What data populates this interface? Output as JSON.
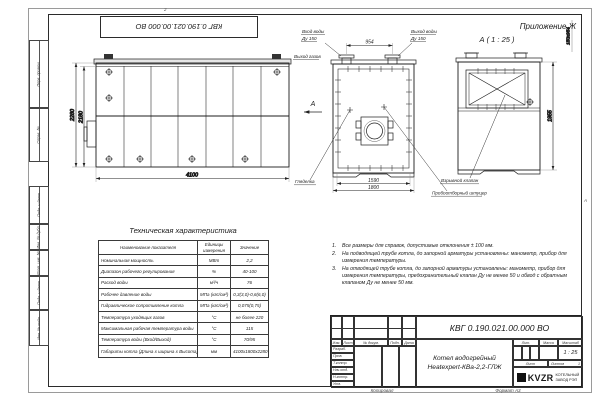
{
  "sheet": {
    "appendix": "Приложение Ж",
    "stamp_number": "КВГ 0.190.021.00.000 ВО",
    "zone_top": "2",
    "zone_right": "А",
    "copied_label": "Копировал",
    "format_label": "Формат А3"
  },
  "frame_columns": {
    "perv_primen": "Перв. примен.",
    "sprav_no": "Справ. №",
    "podp_data1": "Подп. и дата",
    "inv_dubl": "Инв. № дубл.",
    "vzam_inv": "Взам. инв. №",
    "podp_data2": "Подп. и дата",
    "inv_podl": "Инв. № подл."
  },
  "views": {
    "side": {
      "dim_height_outer": "2280",
      "dim_height_inner": "2180",
      "dim_length": "4100"
    },
    "front": {
      "inlet_line1": "Вход воды",
      "inlet_line2": "Ду 150",
      "outlet_line1": "Выход воды",
      "outlet_line2": "Ду 150",
      "gas_label": "Выход газов",
      "dim_top": "954",
      "dim_bottom_inner": "1590",
      "dim_bottom_outer": "1800",
      "section_letter": "А",
      "sight_label": "Гляделка",
      "sampling_label": "Пробоотборный штуцер"
    },
    "section": {
      "title": "А ( 1 : 25 )",
      "dim_height": "1955",
      "dim_top": "150х954",
      "valve_label": "Взрывной клапан"
    }
  },
  "tech_table": {
    "title": "Техническая характеристика",
    "headers": [
      "Наименование показателя",
      "Единицы измерения",
      "Значение"
    ],
    "rows": [
      {
        "name": "Номинальная мощность",
        "unit": "МВт",
        "value": "2,2"
      },
      {
        "name": "Диапазон рабочего регулирования",
        "unit": "%",
        "value": "40-100"
      },
      {
        "name": "Расход воды",
        "unit": "м³/ч",
        "value": "76"
      },
      {
        "name": "Рабочее давление воды",
        "unit": "МПа (кгс/см²)",
        "value": "0,3(3,0)-0,6(6,0)"
      },
      {
        "name": "Гидравлическое сопротивление котла",
        "unit": "МПа (кгс/см²)",
        "value": "0,075(0,75)"
      },
      {
        "name": "Температура уходящих газов",
        "unit": "°С",
        "value": "не более 220"
      },
      {
        "name": "Максимальная рабочая температура воды",
        "unit": "°С",
        "value": "115"
      },
      {
        "name": "Температура воды (Вход/Выход)",
        "unit": "°С",
        "value": "70/95"
      },
      {
        "name": "Габариты котла (Длина х ширина х Высота)",
        "unit": "мм",
        "value": "4100х1800х2280"
      }
    ]
  },
  "notes": {
    "items": [
      {
        "num": "1.",
        "text": "Все размеры для справок, допустимые отклонения ± 100 мм."
      },
      {
        "num": "2.",
        "text": "На подводящей трубе котла, до запорной арматуры установлены: манометр, прибор для измерения температуры."
      },
      {
        "num": "3.",
        "text": "На отводящей трубе котла, до запорной арматуры установлены: манометр, прибор для измерения температуры, предохранительный клапан Ду не менее 50 и обвод с обратным клапаном Ду не менее 50 мм."
      }
    ]
  },
  "title_block": {
    "doc_number": "КВГ 0.190.021.00.000 ВО",
    "product_line1": "Котел водогрейный",
    "product_line2": "Heatexpert-КВа-2,2-ГЛЖ",
    "header_cols": [
      "Изм.",
      "Лист",
      "№ докум.",
      "Подп.",
      "Дата"
    ],
    "sign_rows": [
      "Разраб.",
      "Пров.",
      "Т.контр.",
      "Нач.отд.",
      "Н.контр.",
      "Утв."
    ],
    "lit_label": "Лит.",
    "mass_label": "Масса",
    "scale_label": "Масштаб",
    "scale_value": "1 : 25",
    "sheet_label": "Лист",
    "sheets_label": "Листов",
    "sheets_value": "1",
    "logo_text": "KVZR",
    "company_line1": "КОТЕЛЬНЫЙ",
    "company_line2": "ЗАВОД РЭП"
  }
}
